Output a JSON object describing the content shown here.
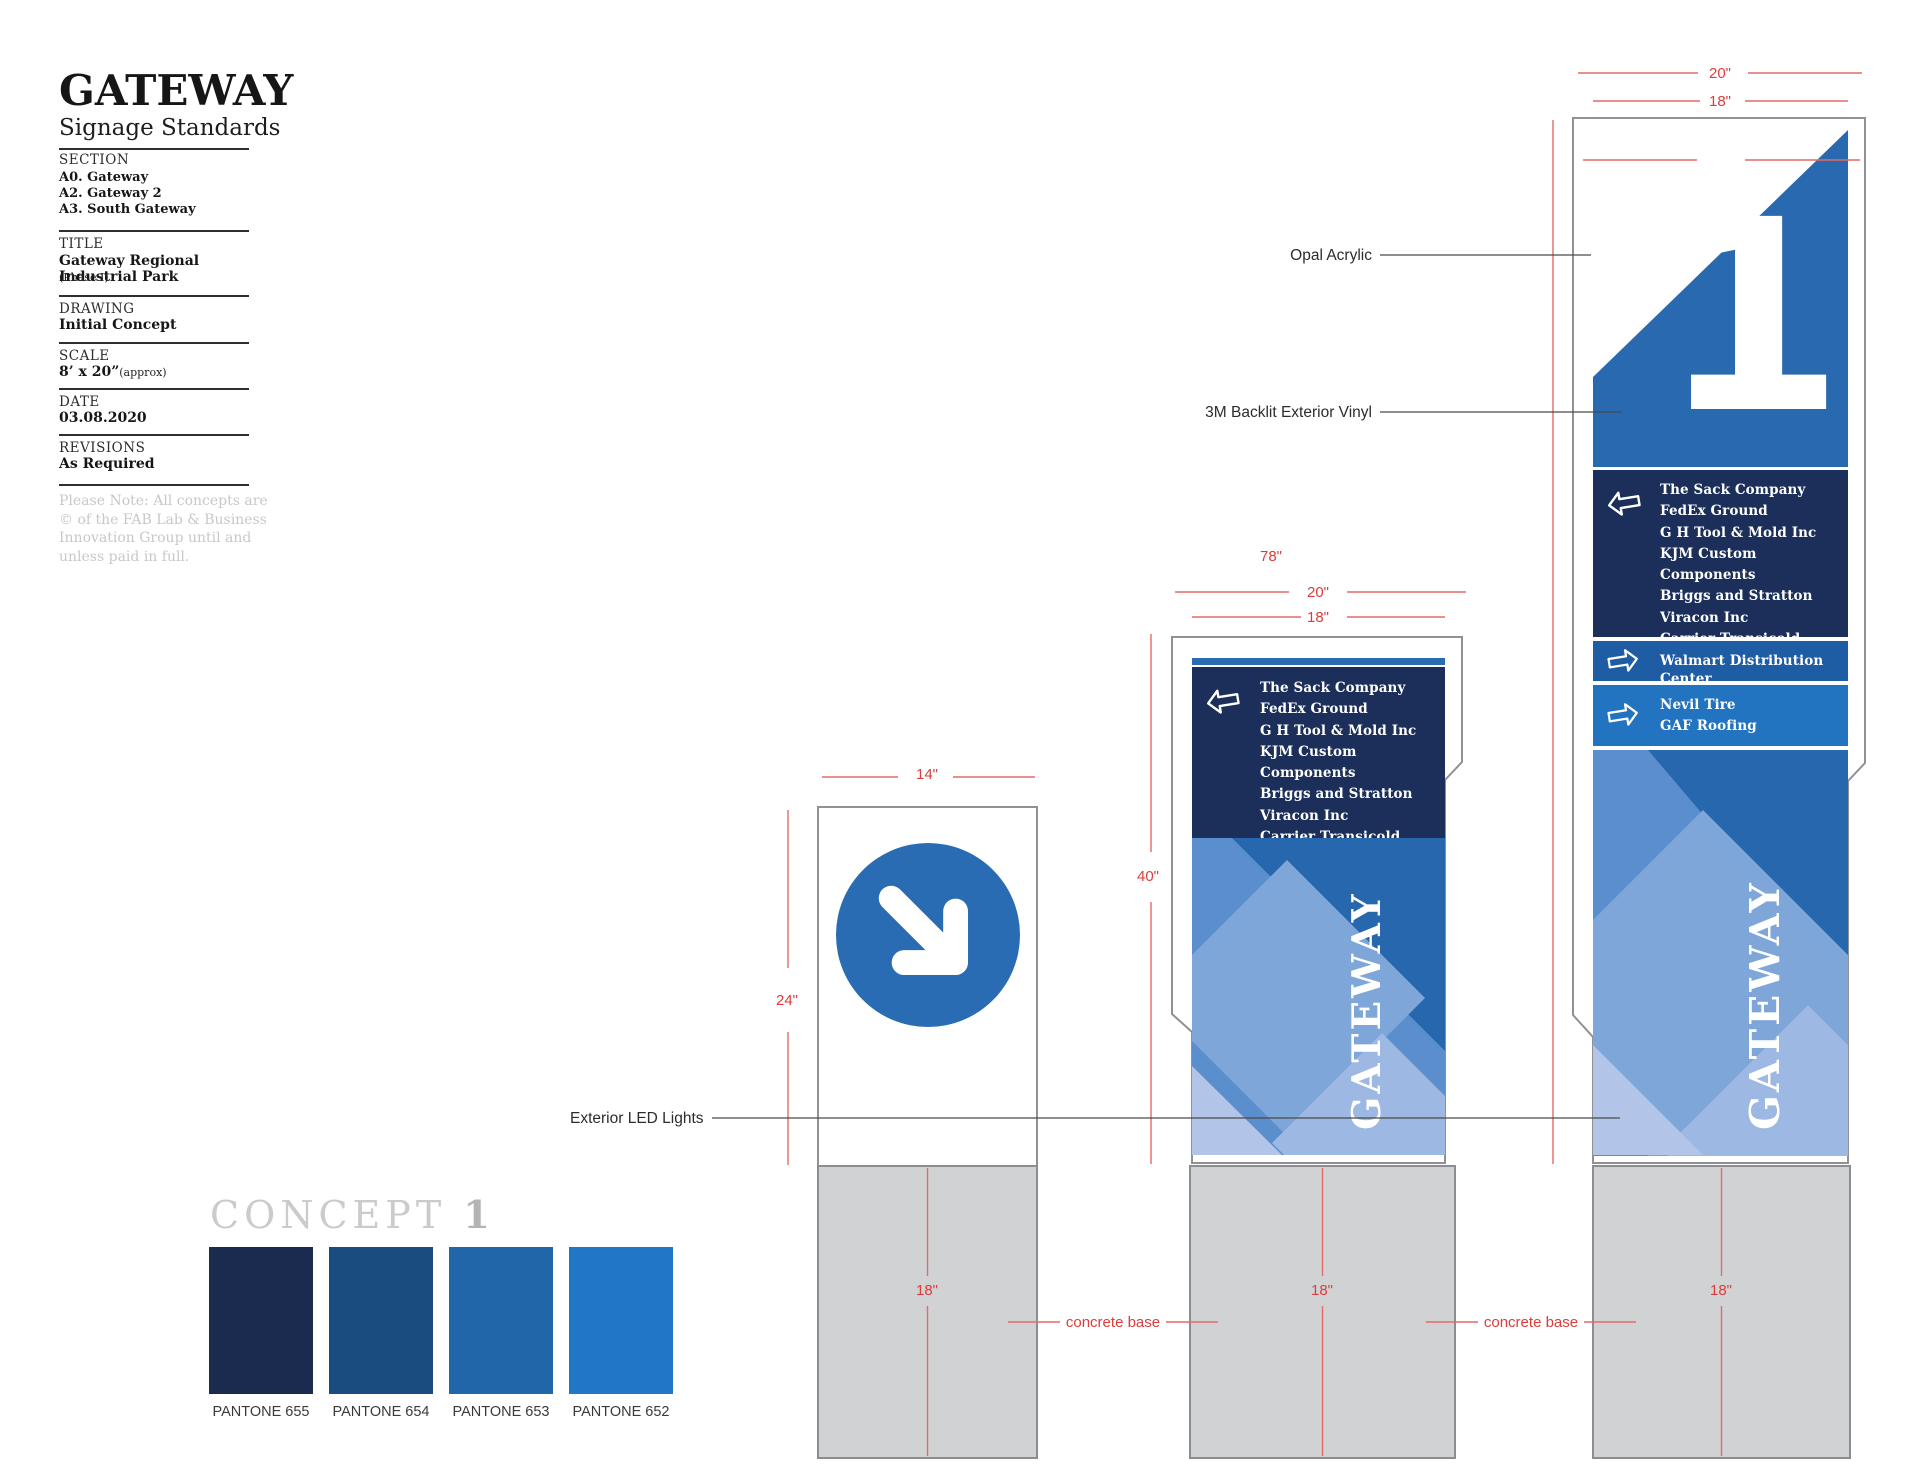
{
  "titleblock": {
    "logo": "GATEWAY",
    "subtitle": "Signage Standards",
    "section_label": "SECTION",
    "sections": [
      "A0. Gateway",
      "A2. Gateway 2",
      "A3. South Gateway"
    ],
    "title_label": "TITLE",
    "title_value": "Gateway Regional Industrial Park",
    "title_note": "(Phase I)",
    "drawing_label": "DRAWING",
    "drawing_value": "Initial Concept",
    "scale_label": "SCALE",
    "scale_value": "8’ x 20”",
    "scale_note": "(approx)",
    "date_label": "DATE",
    "date_value": "03.08.2020",
    "revisions_label": "REVISIONS",
    "revisions_value": "As Required",
    "note_lines": [
      "Please Note: All concepts are",
      "© of the FAB Lab & Business",
      "Innovation Group until and",
      "unless paid in full."
    ]
  },
  "concept_block": {
    "heading": "CONCEPT ",
    "number": "1",
    "swatches": [
      {
        "label": "PANTONE 655",
        "hex": "#1b2b50"
      },
      {
        "label": "PANTONE 654",
        "hex": "#1b4c80"
      },
      {
        "label": "PANTONE 653",
        "hex": "#2166a8"
      },
      {
        "label": "PANTONE 652",
        "hex": "#2077c8"
      }
    ]
  },
  "signs": {
    "tenants": [
      "The Sack Company",
      "FedEx Ground",
      "G H Tool & Mold Inc",
      "KJM Custom Components",
      "Briggs and Stratton",
      "Viracon Inc",
      "Carrier Transicold South"
    ],
    "walmart": "Walmart Distribution Center",
    "nevil_tire": "Nevil Tire",
    "gaf_roofing": "GAF Roofing",
    "gateway_vertical": "GATEWAY",
    "unit_number": "1"
  },
  "annotations": {
    "opal_acrylic": "Opal Acrylic",
    "backlit_vinyl": "3M Backlit Exterior Vinyl",
    "exterior_led": "Exterior LED Lights",
    "concrete_base": "concrete base"
  },
  "dimensions": {
    "width_small": "14\"",
    "height_small": "24\"",
    "width_outer": "20\"",
    "width_inner": "18\"",
    "height_medium": "40\"",
    "height_large": "78\"",
    "base_width": "18\""
  },
  "colors": {
    "panel_navy": "#1b2f5a",
    "panel_blue": "#1e5ca3",
    "panel_light_blue": "#2273c0",
    "accent_blue": "#2a6cb4",
    "sign_blue": "#2969af",
    "dimension_red": "#dc3c3c",
    "concrete_gray": "#d1d2d4"
  }
}
